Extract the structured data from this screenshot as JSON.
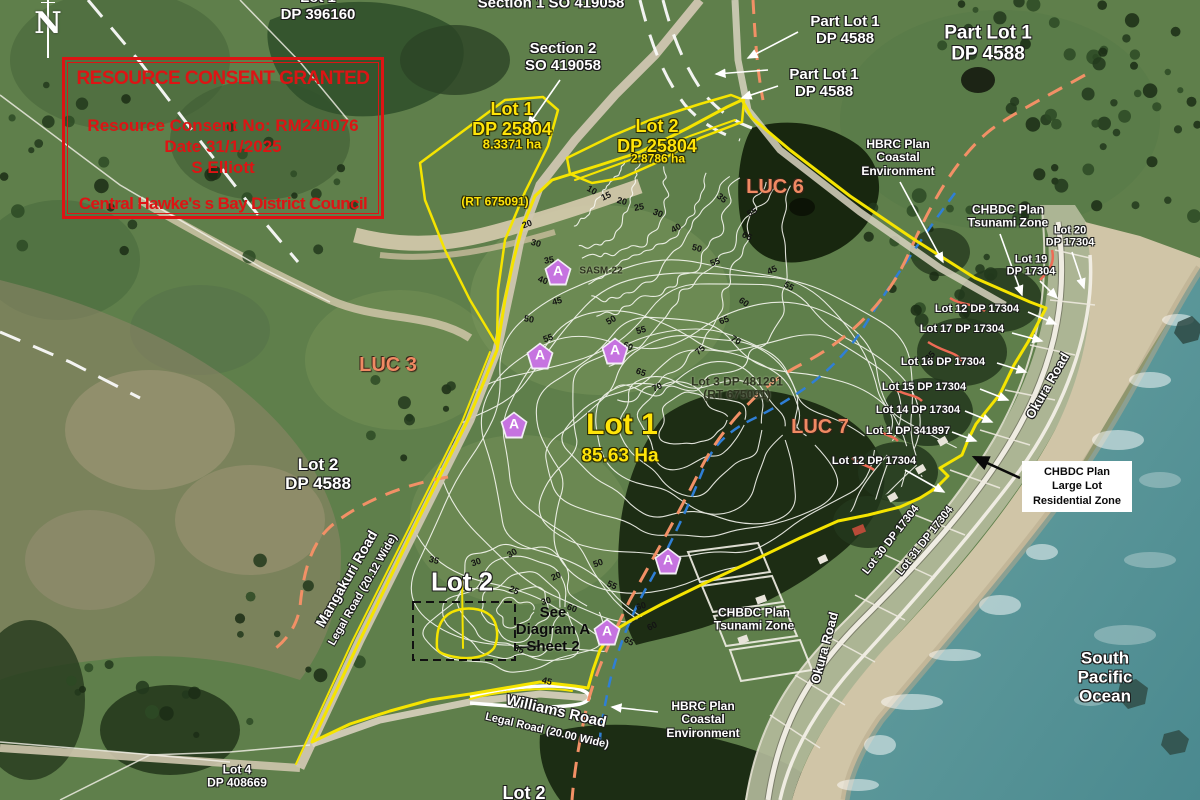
{
  "title": "Resource consent aerial plan - Central Hawke's Bay",
  "compass": {
    "letter": "N"
  },
  "consent_box": {
    "title": "RESOURCE CONSENT GRANTED",
    "number": "Resource Consent No: RM240076",
    "date": "Date 31/1/2025",
    "applicant": "S Elliott",
    "council": "Central Hawke's s Bay District Council"
  },
  "zone_box": {
    "text": "CHBDC Plan\nLarge Lot\nResidential Zone"
  },
  "marker_letter": "A",
  "colors": {
    "boundary_yellow": "#f5e400",
    "zone_orange_dash": "#f29066",
    "luc_text_orange": "#f08a63",
    "coastal_blue_dash": "#2f7fd6",
    "consent_red": "#dd1414",
    "ocean_teal": "#4e8f93",
    "beach_sand": "#d0c5a7",
    "marker_purple": "#c673e0"
  },
  "labels": [
    {
      "name": "lot1-dp396160-label",
      "text": "Lot 1\nDP 396160",
      "cls": "w",
      "size": 15,
      "x": 318,
      "y": 7
    },
    {
      "name": "section1-so419058-label",
      "text": "Section 1 SO 419058",
      "cls": "w",
      "size": 15,
      "x": 551,
      "y": 4
    },
    {
      "name": "section2-so419058-label",
      "text": "Section 2\nSO 419058",
      "cls": "w",
      "size": 15,
      "x": 563,
      "y": 58
    },
    {
      "name": "part-lot1-dp4588-a-label",
      "text": "Part Lot 1\nDP 4588",
      "cls": "w",
      "size": 15,
      "x": 845,
      "y": 31
    },
    {
      "name": "part-lot1-dp4588-b-label",
      "text": "Part Lot 1\nDP 4588",
      "cls": "w",
      "size": 15,
      "x": 824,
      "y": 84
    },
    {
      "name": "part-lot1-dp4588-c-label",
      "text": "Part Lot 1\nDP 4588",
      "cls": "w",
      "size": 19,
      "x": 988,
      "y": 44
    },
    {
      "name": "lot1-dp25804-label",
      "text": "Lot 1\nDP 25804",
      "cls": "y",
      "size": 18,
      "x": 512,
      "y": 119
    },
    {
      "name": "lot1-dp25804-area",
      "text": "8.3371 ha",
      "cls": "y",
      "size": 13,
      "x": 512,
      "y": 145
    },
    {
      "name": "lot2-dp25804-label",
      "text": "Lot 2\nDP 25804",
      "cls": "y",
      "size": 18,
      "x": 657,
      "y": 136
    },
    {
      "name": "lot2-dp25804-area",
      "text": "2.8786 ha",
      "cls": "y",
      "size": 12,
      "x": 658,
      "y": 159
    },
    {
      "name": "rt675091-west-label",
      "text": "(RT 675091)",
      "cls": "y",
      "size": 12,
      "x": 495,
      "y": 202
    },
    {
      "name": "luc6-label",
      "text": "LUC 6",
      "cls": "o",
      "size": 20,
      "x": 775,
      "y": 187
    },
    {
      "name": "hbrc-coastal-top-label",
      "text": "HBRC Plan\nCoastal\nEnvironment",
      "cls": "w",
      "size": 12,
      "x": 898,
      "y": 158
    },
    {
      "name": "chbdc-tsunami-top-label",
      "text": "CHBDC Plan\nTsunami Zone",
      "cls": "w",
      "size": 12,
      "x": 1008,
      "y": 217
    },
    {
      "name": "lot20-dp17304-label",
      "text": "Lot 20\nDP 17304",
      "cls": "w",
      "size": 11,
      "x": 1070,
      "y": 237
    },
    {
      "name": "lot19-dp17304-label",
      "text": "Lot 19\nDP 17304",
      "cls": "w",
      "size": 11,
      "x": 1031,
      "y": 266
    },
    {
      "name": "lot12-dp17304-a-label",
      "text": "Lot 12  DP 17304",
      "cls": "w",
      "size": 11,
      "x": 977,
      "y": 309
    },
    {
      "name": "lot17-dp17304-label",
      "text": "Lot 17  DP 17304",
      "cls": "w",
      "size": 11,
      "x": 962,
      "y": 329
    },
    {
      "name": "lot16-dp17304-label",
      "text": "Lot 16  DP 17304",
      "cls": "w",
      "size": 11,
      "x": 943,
      "y": 362
    },
    {
      "name": "lot15-dp17304-label",
      "text": "Lot 15  DP 17304",
      "cls": "w",
      "size": 11,
      "x": 924,
      "y": 387
    },
    {
      "name": "lot14-dp17304-label",
      "text": "Lot 14  DP 17304",
      "cls": "w",
      "size": 11,
      "x": 918,
      "y": 410
    },
    {
      "name": "lot1-dp341897-label",
      "text": "Lot 1  DP 341897",
      "cls": "w",
      "size": 11,
      "x": 908,
      "y": 431
    },
    {
      "name": "lot12-dp17304-b-label",
      "text": "Lot 12  DP 17304",
      "cls": "w",
      "size": 11,
      "x": 874,
      "y": 461
    },
    {
      "name": "okura-road-upper-label",
      "text": "Okura Road",
      "cls": "w",
      "size": 13,
      "x": 1048,
      "y": 386,
      "rot": -60
    },
    {
      "name": "luc3-label",
      "text": "LUC 3",
      "cls": "o",
      "size": 20,
      "x": 388,
      "y": 365
    },
    {
      "name": "luc7-label",
      "text": "LUC 7",
      "cls": "o",
      "size": 20,
      "x": 820,
      "y": 427
    },
    {
      "name": "lot3-dp481291-label",
      "text": "Lot 3 DP 481291\n(RT 675091)",
      "cls": "dk",
      "size": 12,
      "x": 737,
      "y": 389
    },
    {
      "name": "lot1-main-label",
      "text": "Lot 1",
      "cls": "y",
      "size": 30,
      "x": 622,
      "y": 425
    },
    {
      "name": "lot1-main-area",
      "text": "85.63 Ha",
      "cls": "y",
      "size": 19,
      "x": 620,
      "y": 456
    },
    {
      "name": "lot2-dp4588-label",
      "text": "Lot 2\nDP 4588",
      "cls": "w",
      "size": 17,
      "x": 318,
      "y": 474
    },
    {
      "name": "mangakuri-road-label",
      "text": "Mangakuri Road",
      "cls": "w",
      "size": 14,
      "x": 347,
      "y": 579,
      "rot": -60
    },
    {
      "name": "mangakuri-legal-road-label",
      "text": "Legal Road (20.12 Wide)",
      "cls": "w",
      "size": 11,
      "x": 363,
      "y": 590,
      "rot": -60
    },
    {
      "name": "lot2-main-label",
      "text": "Lot 2",
      "cls": "w",
      "size": 26,
      "x": 462,
      "y": 582
    },
    {
      "name": "see-diagram-a-label",
      "text": "See\nDiagram A\nSheet 2",
      "cls": "k",
      "size": 15,
      "x": 553,
      "y": 630
    },
    {
      "name": "chbdc-tsunami-bottom-label",
      "text": "CHBDC Plan\nTsunami Zone",
      "cls": "w",
      "size": 12,
      "x": 754,
      "y": 620
    },
    {
      "name": "okura-road-lower-label",
      "text": "Okura Road",
      "cls": "w",
      "size": 13,
      "x": 825,
      "y": 648,
      "rot": -75
    },
    {
      "name": "williams-road-label",
      "text": "Williams Road",
      "cls": "w",
      "size": 15,
      "x": 556,
      "y": 712,
      "rot": 13
    },
    {
      "name": "williams-legal-road-label",
      "text": "Legal Road (20.00 Wide)",
      "cls": "w",
      "size": 11,
      "x": 547,
      "y": 731,
      "rot": 13
    },
    {
      "name": "hbrc-coastal-bottom-label",
      "text": "HBRC Plan\nCoastal\nEnvironment",
      "cls": "w",
      "size": 12,
      "x": 703,
      "y": 720
    },
    {
      "name": "south-pacific-ocean-label",
      "text": "South Pacific\nOcean",
      "cls": "w",
      "size": 17,
      "x": 1105,
      "y": 677
    },
    {
      "name": "lot4-dp408669-label",
      "text": "Lot 4\nDP 408669",
      "cls": "w",
      "size": 12,
      "x": 237,
      "y": 777
    },
    {
      "name": "lot2-bottom-label",
      "text": "Lot 2",
      "cls": "w",
      "size": 18,
      "x": 524,
      "y": 793
    },
    {
      "name": "lot30-dp17304-label",
      "text": "Lot 30 DP 17304",
      "cls": "w",
      "size": 11,
      "x": 891,
      "y": 540,
      "rot": -52
    },
    {
      "name": "lot31-dp17304-label",
      "text": "Lot 31 DP 17304",
      "cls": "w",
      "size": 11,
      "x": 925,
      "y": 541,
      "rot": -52
    },
    {
      "name": "sasm22-label",
      "text": "SASM-22",
      "cls": "dk",
      "size": 10,
      "x": 601,
      "y": 271
    }
  ],
  "contour_labels": [
    {
      "t": "20",
      "x": 527,
      "y": 224,
      "r": -20
    },
    {
      "t": "30",
      "x": 536,
      "y": 243,
      "r": 15
    },
    {
      "t": "35",
      "x": 549,
      "y": 260,
      "r": -10
    },
    {
      "t": "40",
      "x": 543,
      "y": 280,
      "r": 20
    },
    {
      "t": "45",
      "x": 557,
      "y": 301,
      "r": -15
    },
    {
      "t": "50",
      "x": 529,
      "y": 319,
      "r": 10
    },
    {
      "t": "55",
      "x": 548,
      "y": 338,
      "r": -20
    },
    {
      "t": "10",
      "x": 592,
      "y": 190,
      "r": 30
    },
    {
      "t": "15",
      "x": 606,
      "y": 196,
      "r": -25
    },
    {
      "t": "20",
      "x": 622,
      "y": 201,
      "r": 15
    },
    {
      "t": "25",
      "x": 639,
      "y": 207,
      "r": -10
    },
    {
      "t": "30",
      "x": 658,
      "y": 213,
      "r": 20
    },
    {
      "t": "40",
      "x": 676,
      "y": 228,
      "r": -30
    },
    {
      "t": "50",
      "x": 697,
      "y": 248,
      "r": 15
    },
    {
      "t": "55",
      "x": 715,
      "y": 262,
      "r": -20
    },
    {
      "t": "35",
      "x": 722,
      "y": 198,
      "r": 40
    },
    {
      "t": "55",
      "x": 752,
      "y": 212,
      "r": -30
    },
    {
      "t": "65",
      "x": 747,
      "y": 236,
      "r": 25
    },
    {
      "t": "75",
      "x": 700,
      "y": 350,
      "r": -40
    },
    {
      "t": "70",
      "x": 736,
      "y": 340,
      "r": 30
    },
    {
      "t": "65",
      "x": 724,
      "y": 320,
      "r": -20
    },
    {
      "t": "60",
      "x": 744,
      "y": 302,
      "r": 35
    },
    {
      "t": "45",
      "x": 772,
      "y": 270,
      "r": -25
    },
    {
      "t": "55",
      "x": 789,
      "y": 286,
      "r": 30
    },
    {
      "t": "35",
      "x": 930,
      "y": 356,
      "r": -45
    },
    {
      "t": "55",
      "x": 641,
      "y": 330,
      "r": -15
    },
    {
      "t": "60",
      "x": 628,
      "y": 346,
      "r": 25
    },
    {
      "t": "50",
      "x": 611,
      "y": 320,
      "r": -30
    },
    {
      "t": "65",
      "x": 641,
      "y": 372,
      "r": 20
    },
    {
      "t": "70",
      "x": 657,
      "y": 387,
      "r": -25
    },
    {
      "t": "50",
      "x": 598,
      "y": 563,
      "r": -20
    },
    {
      "t": "55",
      "x": 612,
      "y": 585,
      "r": 25
    },
    {
      "t": "60",
      "x": 641,
      "y": 606,
      "r": -15
    },
    {
      "t": "65",
      "x": 629,
      "y": 641,
      "r": 30
    },
    {
      "t": "60",
      "x": 652,
      "y": 626,
      "r": -25
    },
    {
      "t": "35",
      "x": 434,
      "y": 560,
      "r": 15
    },
    {
      "t": "30",
      "x": 476,
      "y": 562,
      "r": -20
    },
    {
      "t": "25",
      "x": 514,
      "y": 590,
      "r": 25
    },
    {
      "t": "30",
      "x": 546,
      "y": 601,
      "r": -15
    },
    {
      "t": "35",
      "x": 519,
      "y": 649,
      "r": 20
    },
    {
      "t": "20",
      "x": 556,
      "y": 576,
      "r": -25
    },
    {
      "t": "45",
      "x": 547,
      "y": 681,
      "r": 15
    },
    {
      "t": "30",
      "x": 512,
      "y": 553,
      "r": -30
    },
    {
      "t": "60",
      "x": 572,
      "y": 608,
      "r": 20
    }
  ],
  "markers": [
    {
      "x": 558,
      "y": 272
    },
    {
      "x": 540,
      "y": 356
    },
    {
      "x": 615,
      "y": 351
    },
    {
      "x": 514,
      "y": 425
    },
    {
      "x": 668,
      "y": 561
    },
    {
      "x": 607,
      "y": 632
    }
  ]
}
